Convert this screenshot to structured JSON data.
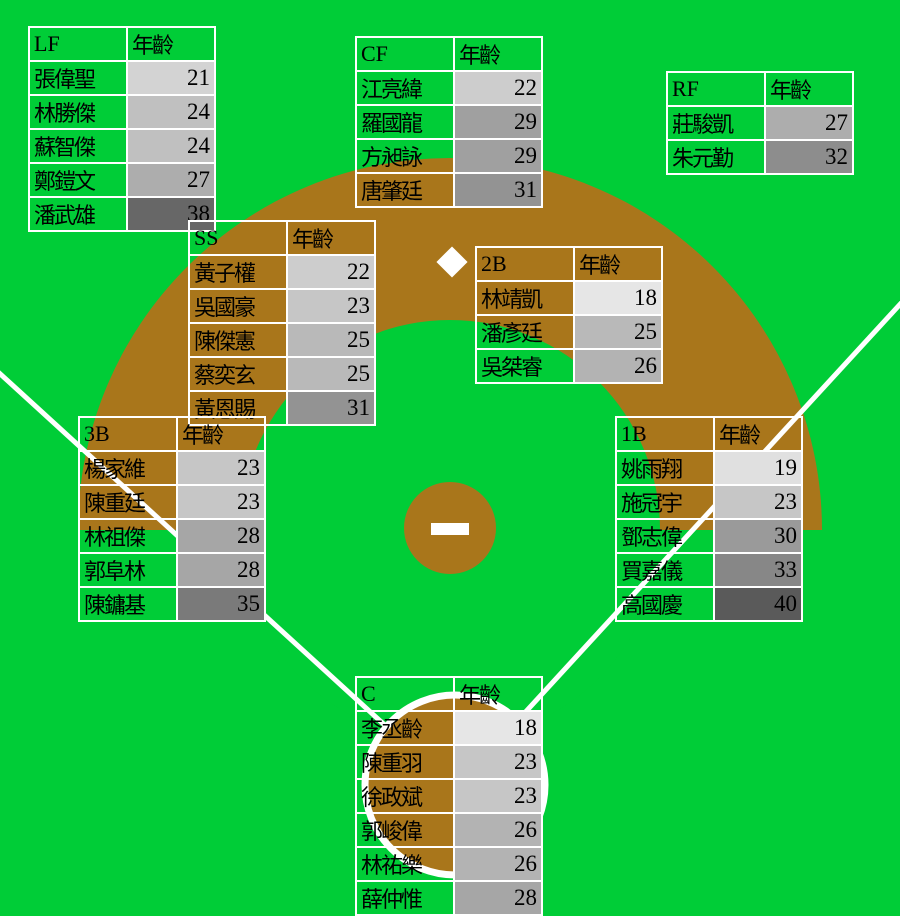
{
  "ui": {
    "age_column_header": "年齡"
  },
  "field": {
    "grass_color": "#00cd37",
    "dirt_color": "#a9761b",
    "line_color": "#ffffff"
  },
  "chart_data": {
    "type": "table",
    "title": "",
    "age_color_scale": {
      "min_age": 18,
      "max_age": 40,
      "light_gray": "#e6e6e6",
      "dark_gray": "#5a5a5a"
    },
    "positions": [
      {
        "code": "LF",
        "players": [
          {
            "name": "張偉聖",
            "age": 21
          },
          {
            "name": "林勝傑",
            "age": 24
          },
          {
            "name": "蘇智傑",
            "age": 24
          },
          {
            "name": "鄭鎧文",
            "age": 27
          },
          {
            "name": "潘武雄",
            "age": 38
          }
        ]
      },
      {
        "code": "CF",
        "players": [
          {
            "name": "江亮緯",
            "age": 22
          },
          {
            "name": "羅國龍",
            "age": 29
          },
          {
            "name": "方昶詠",
            "age": 29
          },
          {
            "name": "唐肇廷",
            "age": 31
          }
        ]
      },
      {
        "code": "RF",
        "players": [
          {
            "name": "莊駿凱",
            "age": 27
          },
          {
            "name": "朱元勤",
            "age": 32
          }
        ]
      },
      {
        "code": "SS",
        "players": [
          {
            "name": "黃子權",
            "age": 22
          },
          {
            "name": "吳國豪",
            "age": 23
          },
          {
            "name": "陳傑憲",
            "age": 25
          },
          {
            "name": "蔡奕玄",
            "age": 25
          },
          {
            "name": "黃恩賜",
            "age": 31
          }
        ]
      },
      {
        "code": "2B",
        "players": [
          {
            "name": "林靖凱",
            "age": 18
          },
          {
            "name": "潘彥廷",
            "age": 25
          },
          {
            "name": "吳桀睿",
            "age": 26
          }
        ]
      },
      {
        "code": "3B",
        "players": [
          {
            "name": "楊家維",
            "age": 23
          },
          {
            "name": "陳重廷",
            "age": 23
          },
          {
            "name": "林祖傑",
            "age": 28
          },
          {
            "name": "郭阜林",
            "age": 28
          },
          {
            "name": "陳鏞基",
            "age": 35
          }
        ]
      },
      {
        "code": "1B",
        "players": [
          {
            "name": "姚雨翔",
            "age": 19
          },
          {
            "name": "施冠宇",
            "age": 23
          },
          {
            "name": "鄧志偉",
            "age": 30
          },
          {
            "name": "買嘉儀",
            "age": 33
          },
          {
            "name": "高國慶",
            "age": 40
          }
        ]
      },
      {
        "code": "C",
        "players": [
          {
            "name": "李丞齡",
            "age": 18
          },
          {
            "name": "陳重羽",
            "age": 23
          },
          {
            "name": "徐政斌",
            "age": 23
          },
          {
            "name": "郭峻偉",
            "age": 26
          },
          {
            "name": "林祐樂",
            "age": 26
          },
          {
            "name": "薛仲惟",
            "age": 28
          }
        ]
      }
    ]
  }
}
